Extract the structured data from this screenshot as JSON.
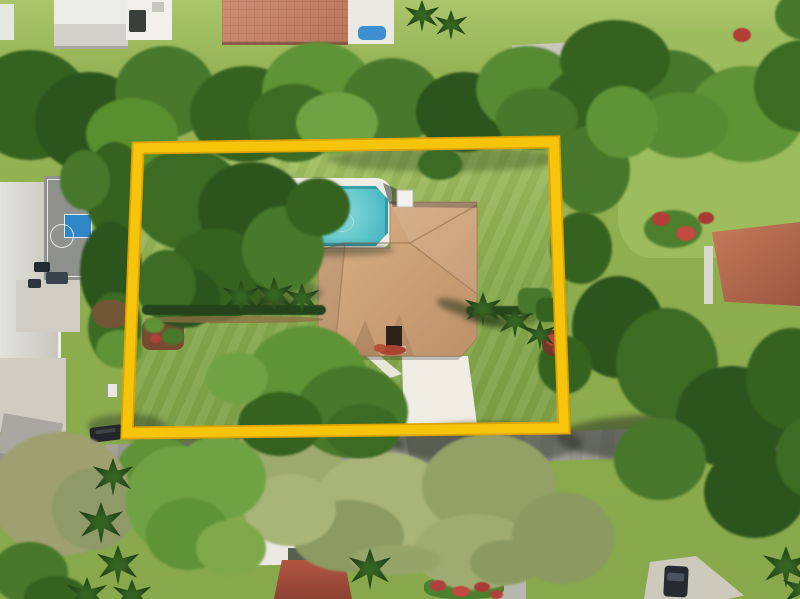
{
  "meta": {
    "description": "Aerial drone photograph of a single-family home with tan tile hip roof, swimming pool and large lawn; the lot is outlined with a thick yellow boundary overlay. A street runs along the bottom, neighbors include a house with basketball court on the left, terracotta-roof homes above and right, and a red tile roof home below.",
    "width": 800,
    "height": 599
  },
  "palette": {
    "boundary_yellow": "#F6C40A",
    "boundary_edge": "#DFA300",
    "pool_water": "#5FC6CB",
    "pool_rim": "#2E98AA",
    "main_roof_tan": "#C79E74",
    "pool_deck_white": "#EFECE3",
    "base_lawn_green": "#8FAF4F",
    "property_lawn_green": "#96B755",
    "road_gray": "#A3A39B",
    "sage_tree_green": "#9DAA6E",
    "dark_tree_green": "#2C541D",
    "neighbor_roof_red": "#B5674C",
    "terracotta_roof": "#C5836B",
    "basketball_key_blue": "#2E86C8",
    "flower_red": "#B0413A",
    "car_dark": "#20252C",
    "driveway_white": "#EFEDE4"
  },
  "boundary": {
    "corners": "138,148 554,142 564,428 127,433"
  },
  "scene": {
    "foliage": [
      {
        "x": -30,
        "y": 50,
        "w": 120,
        "h": 110,
        "c": "#35621F"
      },
      {
        "x": 35,
        "y": 72,
        "w": 110,
        "h": 100,
        "c": "#2C541D"
      },
      {
        "x": 115,
        "y": 46,
        "w": 100,
        "h": 92,
        "c": "#47782B"
      },
      {
        "x": 190,
        "y": 66,
        "w": 112,
        "h": 96,
        "c": "#35621F"
      },
      {
        "x": 262,
        "y": 42,
        "w": 112,
        "h": 100,
        "c": "#5E9336"
      },
      {
        "x": 248,
        "y": 84,
        "w": 92,
        "h": 78,
        "c": "#3C6B24"
      },
      {
        "x": 342,
        "y": 58,
        "w": 100,
        "h": 86,
        "c": "#47782B"
      },
      {
        "x": 416,
        "y": 72,
        "w": 96,
        "h": 80,
        "c": "#2C541D"
      },
      {
        "x": 476,
        "y": 46,
        "w": 102,
        "h": 86,
        "c": "#568A33"
      },
      {
        "x": 542,
        "y": 66,
        "w": 100,
        "h": 86,
        "c": "#35621F"
      },
      {
        "x": 612,
        "y": 50,
        "w": 112,
        "h": 96,
        "c": "#47782B"
      },
      {
        "x": 688,
        "y": 66,
        "w": 116,
        "h": 96,
        "c": "#5E9336"
      },
      {
        "x": 754,
        "y": 40,
        "w": 100,
        "h": 92,
        "c": "#3C6B24"
      },
      {
        "x": 86,
        "y": 98,
        "w": 92,
        "h": 72,
        "c": "#58902F"
      },
      {
        "x": 296,
        "y": 92,
        "w": 82,
        "h": 62,
        "c": "#6FA243"
      },
      {
        "x": 496,
        "y": 88,
        "w": 82,
        "h": 62,
        "c": "#47782B"
      },
      {
        "x": 636,
        "y": 92,
        "w": 92,
        "h": 66,
        "c": "#568A33"
      },
      {
        "x": 560,
        "y": 20,
        "w": 110,
        "h": 80,
        "c": "#35621F"
      },
      {
        "x": 775,
        "y": -10,
        "w": 60,
        "h": 50,
        "c": "#47782B"
      },
      {
        "x": 84,
        "y": 142,
        "w": 62,
        "h": 96,
        "c": "#35621F"
      },
      {
        "x": 80,
        "y": 222,
        "w": 62,
        "h": 98,
        "c": "#2C541D"
      },
      {
        "x": 88,
        "y": 292,
        "w": 54,
        "h": 72,
        "c": "#3C6B24"
      },
      {
        "x": 60,
        "y": 150,
        "w": 50,
        "h": 60,
        "c": "#47782B"
      },
      {
        "x": 96,
        "y": 330,
        "w": 46,
        "h": 38,
        "c": "#5E9336"
      },
      {
        "k": "mulch",
        "x": 92,
        "y": 300,
        "w": 38,
        "h": 28,
        "c": "#7A5238",
        "o": 0.85
      },
      {
        "x": 132,
        "y": 148,
        "w": 112,
        "h": 102,
        "c": "#3C6B24"
      },
      {
        "x": 198,
        "y": 162,
        "w": 108,
        "h": 96,
        "c": "#2C541D"
      },
      {
        "x": 166,
        "y": 228,
        "w": 100,
        "h": 94,
        "c": "#35621F"
      },
      {
        "x": 242,
        "y": 206,
        "w": 82,
        "h": 86,
        "c": "#47782B"
      },
      {
        "x": 148,
        "y": 268,
        "w": 72,
        "h": 60,
        "c": "#2C541D"
      },
      {
        "x": 286,
        "y": 178,
        "w": 64,
        "h": 58,
        "c": "#35621F"
      },
      {
        "n": "small-ornamental-tree",
        "x": 418,
        "y": 148,
        "w": 44,
        "h": 32,
        "c": "#3C6B24"
      },
      {
        "x": 136,
        "y": 250,
        "w": 60,
        "h": 70,
        "c": "#3C6B24"
      },
      {
        "x": 552,
        "y": 126,
        "w": 78,
        "h": 88,
        "c": "#47782B"
      },
      {
        "x": 586,
        "y": 86,
        "w": 72,
        "h": 72,
        "c": "#5E9336"
      },
      {
        "x": 550,
        "y": 212,
        "w": 62,
        "h": 72,
        "c": "#35621F"
      },
      {
        "x": 572,
        "y": 276,
        "w": 92,
        "h": 102,
        "c": "#2C541D"
      },
      {
        "x": 616,
        "y": 308,
        "w": 102,
        "h": 112,
        "c": "#3C6B24"
      },
      {
        "x": 676,
        "y": 366,
        "w": 112,
        "h": 102,
        "c": "#2C541D"
      },
      {
        "x": 746,
        "y": 328,
        "w": 92,
        "h": 102,
        "c": "#35621F"
      },
      {
        "x": 614,
        "y": 418,
        "w": 92,
        "h": 82,
        "c": "#47782B"
      },
      {
        "x": 704,
        "y": 446,
        "w": 102,
        "h": 92,
        "c": "#2C541D"
      },
      {
        "x": 776,
        "y": 416,
        "w": 72,
        "h": 82,
        "c": "#3C6B24"
      },
      {
        "x": 538,
        "y": 336,
        "w": 54,
        "h": 58,
        "c": "#35621F"
      },
      {
        "n": "flowering-shrub-green",
        "x": 644,
        "y": 210,
        "w": 58,
        "h": 38,
        "c": "#4C7F2E"
      },
      {
        "k": "flower",
        "x": 652,
        "y": 212,
        "w": 18,
        "h": 14,
        "c": "#B33E35"
      },
      {
        "k": "flower",
        "x": 676,
        "y": 226,
        "w": 20,
        "h": 15,
        "c": "#C24A3E"
      },
      {
        "k": "flower",
        "x": 698,
        "y": 212,
        "w": 16,
        "h": 12,
        "c": "#A93A32"
      },
      {
        "k": "flower",
        "x": 733,
        "y": 28,
        "w": 18,
        "h": 14,
        "c": "#B33E35"
      },
      {
        "x": 222,
        "y": 424,
        "w": 124,
        "h": 102,
        "c": "#9DAA6E"
      },
      {
        "x": 312,
        "y": 452,
        "w": 144,
        "h": 112,
        "c": "#A9B478"
      },
      {
        "x": 422,
        "y": 434,
        "w": 134,
        "h": 102,
        "c": "#93A166"
      },
      {
        "x": 292,
        "y": 500,
        "w": 112,
        "h": 72,
        "c": "#8C9B62"
      },
      {
        "x": 414,
        "y": 514,
        "w": 122,
        "h": 76,
        "c": "#9FAC71"
      },
      {
        "x": 512,
        "y": 492,
        "w": 102,
        "h": 92,
        "c": "#8A9A60"
      },
      {
        "x": 244,
        "y": 474,
        "w": 92,
        "h": 72,
        "c": "#A9B478"
      },
      {
        "x": 172,
        "y": 436,
        "w": 94,
        "h": 84,
        "c": "#6FA243"
      },
      {
        "x": 116,
        "y": 436,
        "w": 82,
        "h": 72,
        "c": "#5E9336"
      },
      {
        "x": 350,
        "y": 545,
        "w": 90,
        "h": 30,
        "c": "#95A468"
      },
      {
        "x": 470,
        "y": 540,
        "w": 70,
        "h": 45,
        "c": "#8A9A60"
      },
      {
        "n": "dry-tree",
        "x": -10,
        "y": 432,
        "w": 140,
        "h": 124,
        "c": "#9FA070"
      },
      {
        "x": 52,
        "y": 468,
        "w": 84,
        "h": 82,
        "c": "#8F9A68"
      },
      {
        "x": 126,
        "y": 446,
        "w": 102,
        "h": 108,
        "c": "#6FA243"
      },
      {
        "x": 146,
        "y": 498,
        "w": 84,
        "h": 72,
        "c": "#5E9336"
      },
      {
        "x": -8,
        "y": 542,
        "w": 76,
        "h": 62,
        "c": "#47782B"
      },
      {
        "x": 24,
        "y": 576,
        "w": 64,
        "h": 42,
        "c": "#35621F"
      },
      {
        "x": 196,
        "y": 520,
        "w": 70,
        "h": 56,
        "c": "#7FA84A"
      },
      {
        "x": 246,
        "y": 326,
        "w": 122,
        "h": 108,
        "c": "#5E9336"
      },
      {
        "x": 296,
        "y": 366,
        "w": 112,
        "h": 92,
        "c": "#47782B"
      },
      {
        "x": 238,
        "y": 392,
        "w": 84,
        "h": 64,
        "c": "#35621F"
      },
      {
        "x": 326,
        "y": 404,
        "w": 74,
        "h": 54,
        "c": "#3C6B24"
      },
      {
        "x": 206,
        "y": 352,
        "w": 62,
        "h": 52,
        "c": "#6FA243"
      },
      {
        "k": "hedge",
        "n": "west-hedge-row",
        "x": 142,
        "y": 305,
        "w": 184,
        "h": 10,
        "c": "#24431A"
      },
      {
        "k": "hedge",
        "n": "east-hedge-row",
        "x": 466,
        "y": 306,
        "w": 70,
        "h": 9,
        "c": "#27481C"
      },
      {
        "k": "mulch",
        "x": 145,
        "y": 316,
        "w": 178,
        "h": 7,
        "c": "#8F6F45",
        "o": 0.75
      },
      {
        "k": "hedge",
        "x": 518,
        "y": 288,
        "w": 34,
        "h": 26,
        "c": "#47782B"
      },
      {
        "k": "hedge",
        "x": 536,
        "y": 298,
        "w": 28,
        "h": 24,
        "c": "#35621F"
      },
      {
        "k": "mulch",
        "x": 542,
        "y": 330,
        "w": 24,
        "h": 26,
        "c": "#6B3A28"
      },
      {
        "k": "flower",
        "x": 546,
        "y": 334,
        "w": 14,
        "h": 12,
        "c": "#B8453C"
      },
      {
        "k": "flower",
        "x": 552,
        "y": 344,
        "w": 12,
        "h": 10,
        "c": "#A93A32"
      },
      {
        "x": 144,
        "y": 318,
        "w": 20,
        "h": 15,
        "c": "#5E9336"
      },
      {
        "x": 162,
        "y": 328,
        "w": 22,
        "h": 17,
        "c": "#47782B"
      },
      {
        "k": "flower",
        "x": 150,
        "y": 334,
        "w": 11,
        "h": 9,
        "c": "#B0413A"
      },
      {
        "k": "flower",
        "x": 430,
        "y": 580,
        "w": 16,
        "h": 11,
        "c": "#B0413A"
      },
      {
        "k": "flower",
        "x": 452,
        "y": 586,
        "w": 18,
        "h": 11,
        "c": "#C24A3E"
      },
      {
        "k": "flower",
        "x": 474,
        "y": 582,
        "w": 16,
        "h": 10,
        "c": "#A93A32"
      },
      {
        "k": "flower",
        "x": 490,
        "y": 590,
        "w": 13,
        "h": 9,
        "c": "#B0413A"
      },
      {
        "k": "palm",
        "x": 222,
        "y": 280,
        "w": 38,
        "h": 34
      },
      {
        "k": "palm",
        "x": 254,
        "y": 277,
        "w": 40,
        "h": 36
      },
      {
        "k": "palm",
        "x": 284,
        "y": 283,
        "w": 36,
        "h": 32
      },
      {
        "k": "palm",
        "x": 464,
        "y": 292,
        "w": 38,
        "h": 34
      },
      {
        "k": "palm",
        "x": 497,
        "y": 306,
        "w": 36,
        "h": 32
      },
      {
        "k": "palm",
        "x": 524,
        "y": 320,
        "w": 32,
        "h": 30
      },
      {
        "k": "palm",
        "x": 92,
        "y": 458,
        "w": 42,
        "h": 38
      },
      {
        "k": "palm",
        "x": 78,
        "y": 502,
        "w": 46,
        "h": 42
      },
      {
        "k": "palm",
        "x": 96,
        "y": 545,
        "w": 44,
        "h": 40
      },
      {
        "k": "palm",
        "x": 66,
        "y": 577,
        "w": 42,
        "h": 36
      },
      {
        "k": "palm",
        "x": 112,
        "y": 579,
        "w": 40,
        "h": 34
      },
      {
        "k": "palm",
        "x": 348,
        "y": 548,
        "w": 44,
        "h": 42
      },
      {
        "k": "palm",
        "x": 404,
        "y": 0,
        "w": 36,
        "h": 32
      },
      {
        "k": "palm",
        "x": 434,
        "y": 10,
        "w": 34,
        "h": 30
      },
      {
        "k": "palm",
        "x": 762,
        "y": 546,
        "w": 48,
        "h": 42
      },
      {
        "k": "palm",
        "x": 782,
        "y": 572,
        "w": 42,
        "h": 36
      }
    ],
    "shadows": [
      {
        "x": 328,
        "y": 146,
        "w": 232,
        "h": 26,
        "c": "rgba(25,45,18,0.30)"
      },
      {
        "x": 138,
        "y": 272,
        "w": 184,
        "h": 42,
        "c": "rgba(25,45,18,0.32)"
      },
      {
        "x": 420,
        "y": 158,
        "w": 42,
        "h": 15,
        "c": "rgba(25,45,18,0.35)"
      },
      {
        "x": 392,
        "y": 422,
        "w": 190,
        "h": 42,
        "c": "rgba(38,44,34,0.45)"
      },
      {
        "x": 556,
        "y": 414,
        "w": 240,
        "h": 48,
        "c": "rgba(38,44,34,0.50)"
      },
      {
        "x": 88,
        "y": 414,
        "w": 78,
        "h": 24,
        "c": "rgba(38,44,34,0.40)"
      },
      {
        "x": 134,
        "y": 430,
        "w": 270,
        "h": 28,
        "c": "rgba(36,42,32,0.42)"
      },
      {
        "x": 276,
        "y": 244,
        "w": 118,
        "h": 12,
        "c": "rgba(30,45,35,0.40)"
      },
      {
        "x": 462,
        "y": 312,
        "w": 84,
        "h": 12,
        "c": "rgba(25,45,18,0.35)"
      },
      {
        "x": 194,
        "y": 288,
        "w": 44,
        "h": 13,
        "c": "rgba(22,42,16,0.50)",
        "r": 18
      },
      {
        "x": 226,
        "y": 292,
        "w": 46,
        "h": 13,
        "c": "rgba(22,42,16,0.50)",
        "r": 18
      },
      {
        "x": 256,
        "y": 296,
        "w": 42,
        "h": 12,
        "c": "rgba(22,42,16,0.50)",
        "r": 18
      },
      {
        "x": 436,
        "y": 301,
        "w": 44,
        "h": 13,
        "c": "rgba(22,42,16,0.50)",
        "r": 18
      },
      {
        "x": 468,
        "y": 314,
        "w": 42,
        "h": 12,
        "c": "rgba(22,42,16,0.50)",
        "r": 18
      }
    ]
  }
}
